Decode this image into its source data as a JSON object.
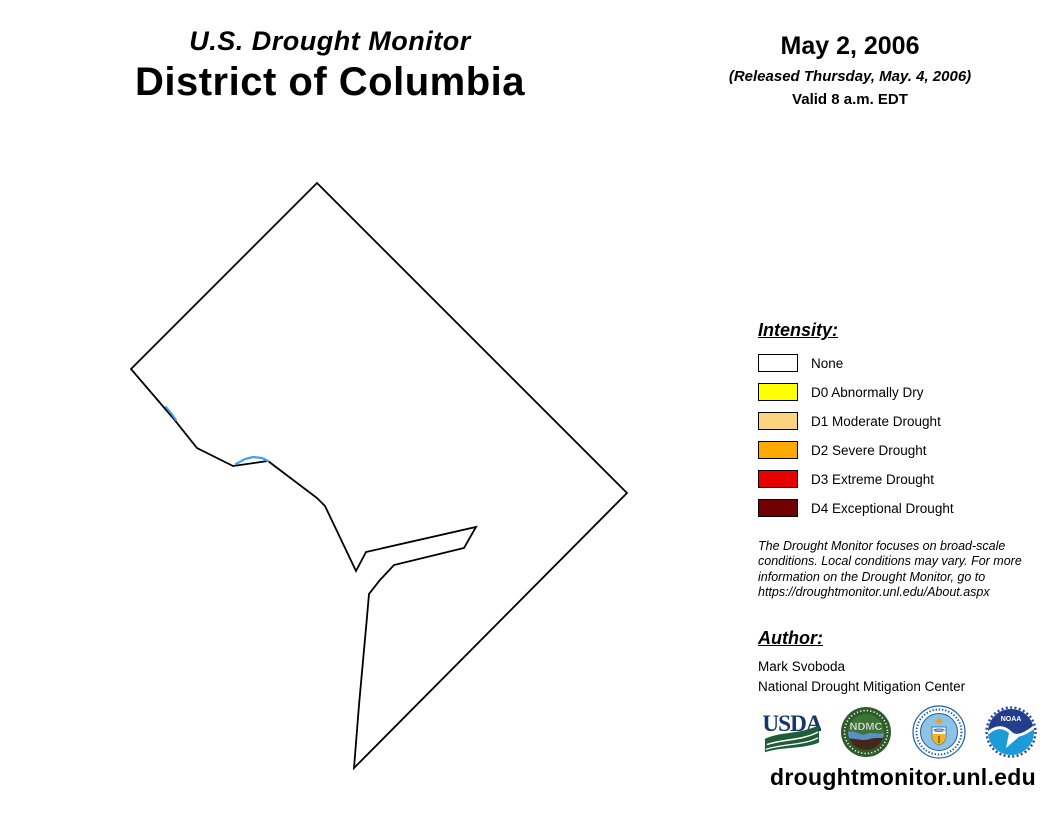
{
  "header": {
    "title_line1": "U.S. Drought Monitor",
    "title_line2": "District of Columbia",
    "date": "May 2, 2006",
    "released": "(Released Thursday, May. 4, 2006)",
    "valid": "Valid 8 a.m. EDT"
  },
  "map": {
    "region": "District of Columbia",
    "category_shown": "None",
    "fill_color": "#FFFFFF",
    "outline_color": "#000000",
    "river_color": "#3FA0F0",
    "outline_points": "317,183 627,493 354,768 359,705 367,617 369,594 380,580 394,565 464,548 476,527 366,552 356,571 325,506 317,498 268,461 233,466 197,448 173,418 131,369",
    "rivers": {
      "potomac_arc": "236,464 245,459 253,457 262,458 268,461",
      "potomac_upper": "166,407 171,413 176,420"
    }
  },
  "legend": {
    "heading": "Intensity:",
    "items": [
      {
        "label": "None",
        "color": "#FFFFFF"
      },
      {
        "label": "D0 Abnormally Dry",
        "color": "#FFFF00"
      },
      {
        "label": "D1 Moderate Drought",
        "color": "#FCD37F"
      },
      {
        "label": "D2 Severe Drought",
        "color": "#FFAA00"
      },
      {
        "label": "D3 Extreme Drought",
        "color": "#E60000"
      },
      {
        "label": "D4 Exceptional Drought",
        "color": "#730000"
      }
    ]
  },
  "disclaimer": {
    "lines": [
      "The Drought Monitor focuses on broad-scale",
      "conditions. Local conditions may vary. For more",
      "information on the Drought Monitor, go to",
      "https://droughtmonitor.unl.edu/About.aspx"
    ]
  },
  "author": {
    "heading": "Author:",
    "name": "Mark Svoboda",
    "org": "National Drought Mitigation Center"
  },
  "logos": {
    "usda_text": "USDA",
    "ndmc_text": "NDMC",
    "noaa_text": "NOAA"
  },
  "footer": {
    "url": "droughtmonitor.unl.edu"
  }
}
